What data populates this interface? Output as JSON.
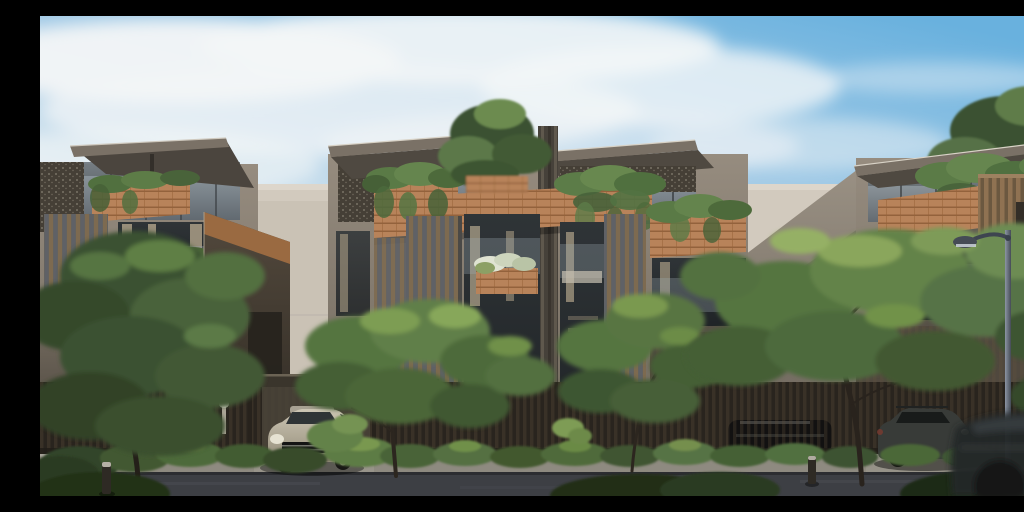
{
  "scene": {
    "kind": "architectural-exterior-rendering",
    "objects": [
      "sky-with-clouds",
      "background-building",
      "left-townhouse",
      "center-townhouses",
      "right-townhouse",
      "rooftop-trees",
      "balcony-planters",
      "street-fence",
      "carport",
      "hedge-row",
      "street-trees",
      "silver-suv",
      "dark-suv",
      "car-behind-fence",
      "passing-car",
      "street-lamp",
      "bollards",
      "path-light",
      "sidewalk",
      "road"
    ],
    "counts": {
      "townhouse-blocks": 3,
      "visible-cars": 4,
      "bollards": 2,
      "street-lamps": 1
    }
  },
  "palette": {
    "sky_blue": "#69b1de",
    "cloud_white": "#f3f6f7",
    "building_light": "#d2cabe",
    "wall_taupe": "#8d8478",
    "roof_fascia": "#7a7166",
    "brick": "#b8835a",
    "slat_gray": "#5f6166",
    "slat_brown": "#7d6a50",
    "slat_tan": "#8f7252",
    "window_dark": "#343a3d",
    "fence_dark": "#29241e",
    "foliage_dark": "#3a5130",
    "foliage_mid": "#557540",
    "foliage_light": "#8aa65c",
    "trunk_brown": "#29231d",
    "hedge_green": "#4a6437",
    "sidewalk_gray": "#8e8a80",
    "road_asphalt": "#3d3f44",
    "car_silver": "#b9b1a1",
    "car_dark": "#383b38",
    "lamp_metal": "#454b55",
    "flower_white": "#dfe3d2",
    "curtain_beige": "#b3a58c"
  }
}
